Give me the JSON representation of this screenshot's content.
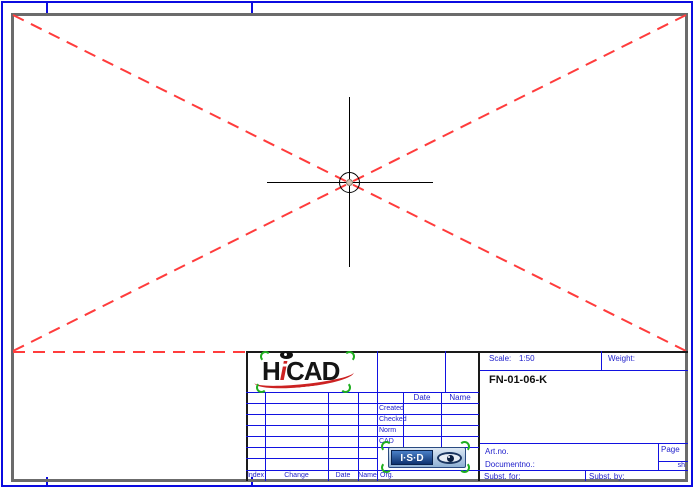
{
  "title_block": {
    "scale_label": "Scale:",
    "scale_value": "1:50",
    "weight_label": "Weight:",
    "drawing_number": "FN-01-06-K",
    "header": {
      "date": "Date",
      "name": "Name"
    },
    "rows": [
      "Created",
      "Checked",
      "Norm",
      "CAD"
    ],
    "artno_label": "Art.no.",
    "documentno_label": "Documentno.:",
    "page_label": "Page",
    "sheet_label": "sh",
    "subst_for_label": "Subst. for:",
    "subst_by_label": "Subst. by:",
    "bottom_row": {
      "index": "Index",
      "change": "Change",
      "date": "Date",
      "name": "Name",
      "org": "Org."
    }
  },
  "logos": {
    "hicad": {
      "part_h": "H",
      "part_i": "i",
      "part_cad": "CAD"
    },
    "isd": {
      "text": "I·S·D"
    }
  },
  "colors": {
    "border_blue": "#0b0be0",
    "line_blue": "#1212e0",
    "text_blue": "#2222cc",
    "frame_gray": "#6b6b6b",
    "dash_red": "#ff3c3c",
    "mark_green": "#1fae1f",
    "logo_red": "#cc2222"
  }
}
